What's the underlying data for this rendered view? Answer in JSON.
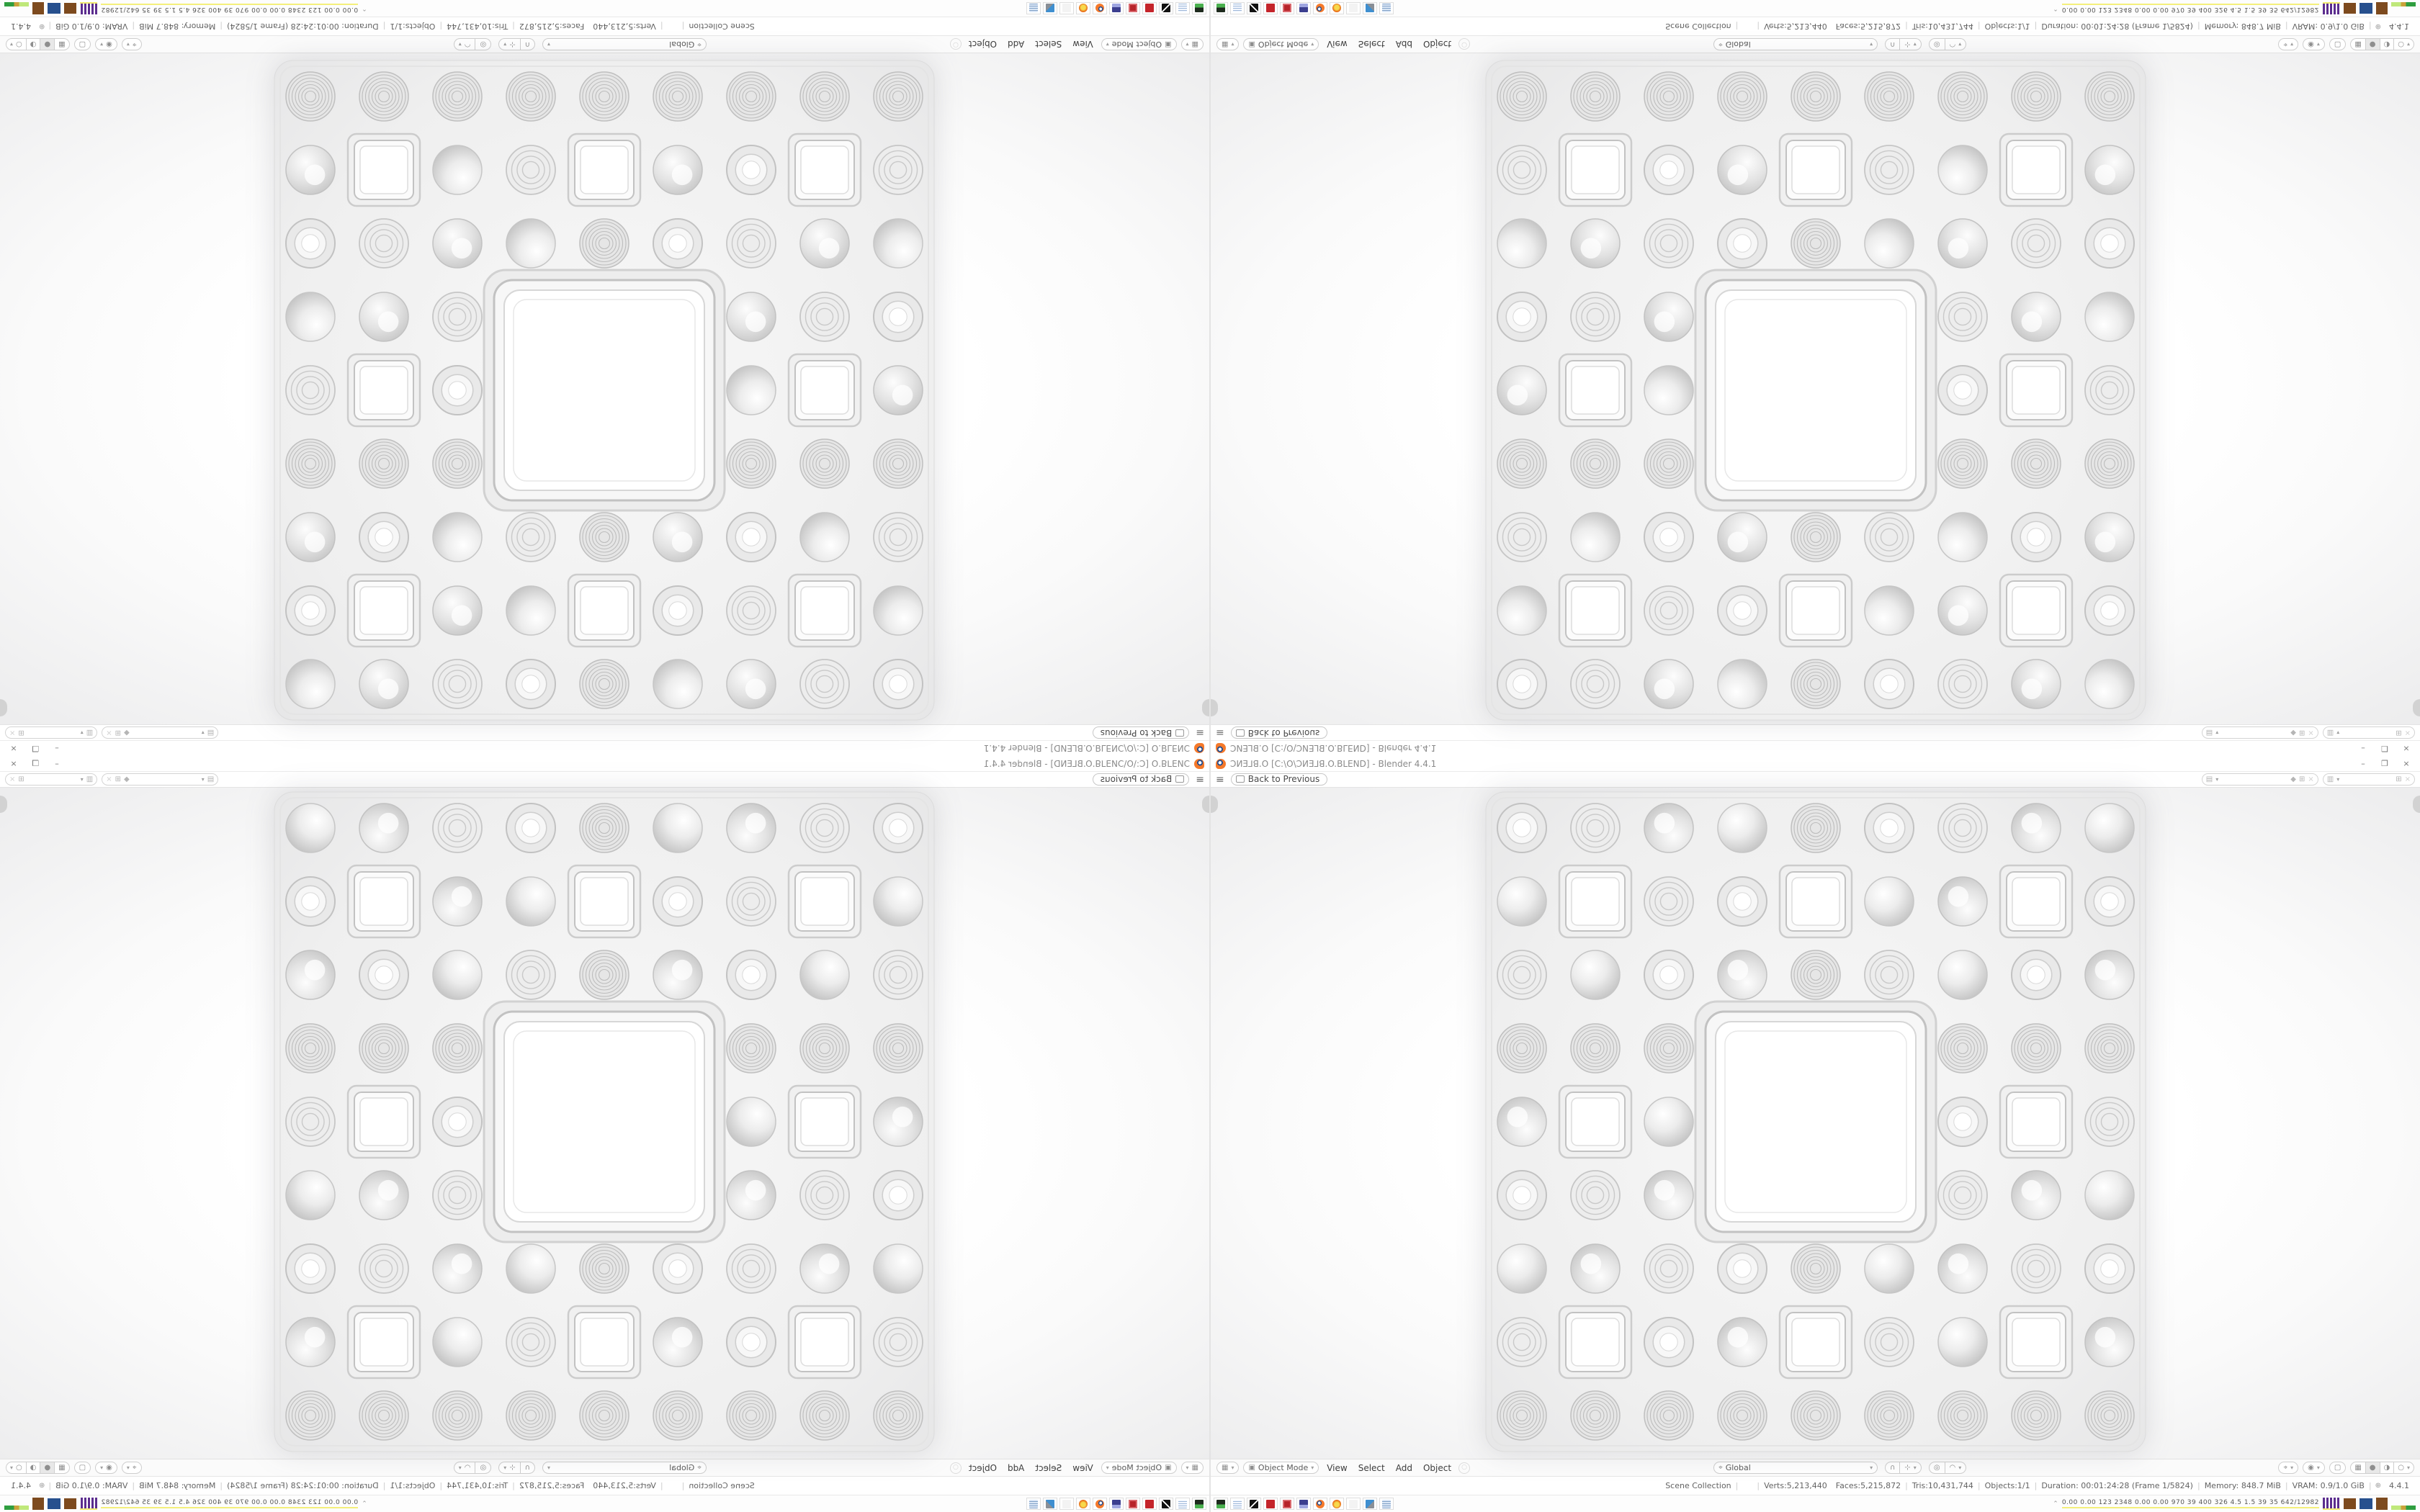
{
  "window": {
    "titlebar": {
      "title": "ƆИƎ⅃ꓭ.O [C:\\O\\ƆИƎ⅃ꓭ.O.BLEND] - Blender 4.4.1",
      "minimize": "–",
      "restore": "❐",
      "close": "×"
    },
    "topbar": {
      "menu_icon": "≡",
      "back_label": "Back to Previous"
    },
    "viewport_header": {
      "editor_glyph": "▦",
      "mode_glyph": "▣",
      "mode": "Object Mode",
      "menus": [
        "View",
        "Select",
        "Add",
        "Object"
      ],
      "orientation_glyph": "⌖",
      "orientation": "Global",
      "snap_glyph": "∩",
      "proportional_glyph": "◎",
      "shading_glyphs": [
        "▦",
        "●",
        "◑",
        "○"
      ]
    },
    "status_bar": {
      "scene": "Scene Collection",
      "verts": "Verts:5,213,440",
      "faces": "Faces:5,215,872",
      "tris": "Tris:10,431,744",
      "objects": "Objects:1/1",
      "duration": "Duration: 00:01:24:28 (Frame 1/5824)",
      "memory": "Memory: 848.7 MiB",
      "vram": "VRAM: 0.9/1.0 GiB",
      "version": "4.4.1",
      "separator": "|"
    }
  },
  "taskbar": {
    "icons": [
      "media-player-icon",
      "notepad-icon",
      "gimp-icon",
      "red-settings-icon",
      "red-gear-icon",
      "backup-floppy-icon",
      "blender-app-icon",
      "firefox-icon",
      "empty-slot-icon",
      "system-settings-icon",
      "calculator-icon"
    ],
    "tray_chevron": "⌃",
    "tray_text": "0.00 0.00 123 2348 0.00 0.00 970 39 400 326 4.5 1.5 39 35 642/12982"
  },
  "fractal": {
    "grid": 9,
    "size": 918,
    "tile_fill": "#efefef",
    "ring_stroke": "#c2c2c2",
    "hole_fill": "#ffffff"
  },
  "colors": {
    "accent_orange": "#f5792a",
    "ui_background": "#ffffff",
    "ui_border": "#e0e0e0",
    "text_gray": "#555555"
  }
}
